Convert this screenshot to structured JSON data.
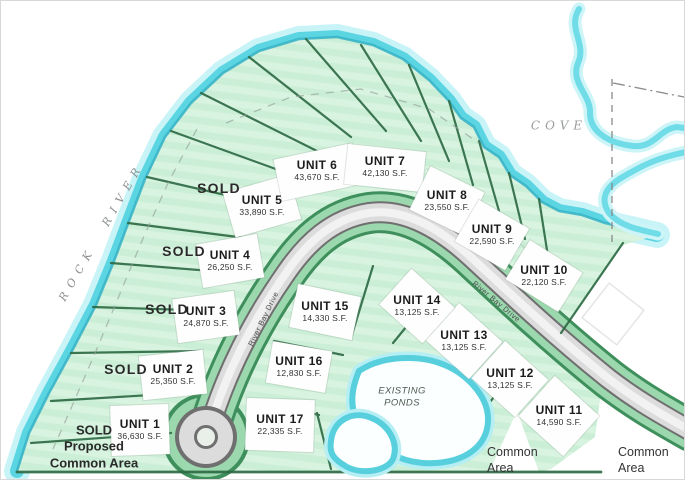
{
  "map_title": "River Bay Drive subdivision plat",
  "units": [
    {
      "name": "UNIT 1",
      "sqft": "36,630 S.F."
    },
    {
      "name": "UNIT 2",
      "sqft": "25,350 S.F."
    },
    {
      "name": "UNIT 3",
      "sqft": "24,870 S.F."
    },
    {
      "name": "UNIT 4",
      "sqft": "26,250 S.F."
    },
    {
      "name": "UNIT 5",
      "sqft": "33,890 S.F."
    },
    {
      "name": "UNIT 6",
      "sqft": "43,670 S.F."
    },
    {
      "name": "UNIT 7",
      "sqft": "42,130 S.F."
    },
    {
      "name": "UNIT 8",
      "sqft": "23,550 S.F."
    },
    {
      "name": "UNIT 9",
      "sqft": "22,590 S.F."
    },
    {
      "name": "UNIT 10",
      "sqft": "22,120 S.F."
    },
    {
      "name": "UNIT 11",
      "sqft": "14,590 S.F."
    },
    {
      "name": "UNIT 12",
      "sqft": "13,125 S.F."
    },
    {
      "name": "UNIT 13",
      "sqft": "13,125 S.F."
    },
    {
      "name": "UNIT 14",
      "sqft": "13,125 S.F."
    },
    {
      "name": "UNIT 15",
      "sqft": "14,330 S.F."
    },
    {
      "name": "UNIT 16",
      "sqft": "12,830 S.F."
    },
    {
      "name": "UNIT 17",
      "sqft": "22,335 S.F."
    }
  ],
  "sold_labels": [
    "SOLD",
    "SOLD",
    "SOLD",
    "SOLD"
  ],
  "proposed_common_area": "SOLD\nProposed\nCommon Area",
  "common_area_labels": [
    "Common\nArea",
    "Common\nArea"
  ],
  "water_labels": {
    "river": "ROCK RIVER",
    "cove": "COVE",
    "ponds": "EXISTING\nPONDS"
  },
  "road_labels": [
    "River Bay Drive",
    "River Bay Drive"
  ],
  "colors": {
    "land_green": "#cbeed6",
    "land_stripe": "#d8f3e0",
    "lot_line_green": "#2e6b45",
    "corridor_green": "#9bd8ae",
    "corridor_rim": "#3f8f5c",
    "river_cyan": "#5cd5e3",
    "river_edge": "#35b2c6",
    "road_gray": "#dcdcdc",
    "road_outline": "#6f6f6f"
  }
}
